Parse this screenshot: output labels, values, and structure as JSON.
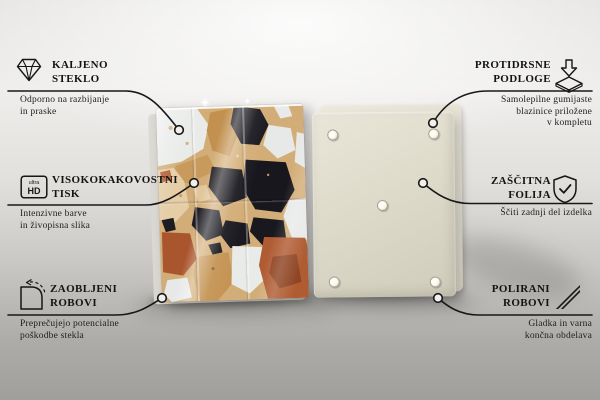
{
  "callouts": {
    "left": [
      {
        "id": "tempered-glass",
        "icon": "diamond-icon",
        "title_lines": [
          "KALJENO",
          "STEKLO"
        ],
        "subtitle_lines": [
          "Odporno na razbijanje",
          "in praske"
        ]
      },
      {
        "id": "high-quality-print",
        "icon": "ultra-hd-icon",
        "icon_text_top": "ultra",
        "icon_text_bottom": "HD",
        "title_lines": [
          "VISOKOKAKOVOSTNI",
          "TISK"
        ],
        "subtitle_lines": [
          "Intenzivne barve",
          "in živopisna slika"
        ]
      },
      {
        "id": "rounded-edges",
        "icon": "rounded-corner-icon",
        "title_lines": [
          "ZAOBLJENI",
          "ROBOVI"
        ],
        "subtitle_lines": [
          "Preprečujejo potencialne",
          "poškodbe stekla"
        ]
      }
    ],
    "right": [
      {
        "id": "anti-slip-pads",
        "icon": "anti-slip-pad-icon",
        "title_lines": [
          "PROTIDRSNE",
          "PODLOGE"
        ],
        "subtitle_lines": [
          "Samolepilne gumijaste",
          "blazinice priložene",
          "v kompletu"
        ]
      },
      {
        "id": "protective-film",
        "icon": "shield-check-icon",
        "title_lines": [
          "ZAŠČITNA",
          "FOLIJA"
        ],
        "subtitle_lines": [
          "Ščiti zadnji del izdelka"
        ]
      },
      {
        "id": "polished-edges",
        "icon": "polished-edges-icon",
        "title_lines": [
          "POLIRANI",
          "ROBOVI"
        ],
        "subtitle_lines": [
          "Gladka in varna",
          "končna obdelava"
        ]
      }
    ]
  },
  "product": {
    "front_panel": "terrazzo-print-glass-board",
    "back_panel": "cream-back-panel-with-pads",
    "back_pad_count": 5
  },
  "colors": {
    "text": "#141414",
    "connector_line": "#181818",
    "background_top": "#f0efed",
    "background_bottom": "#a19f9b",
    "back_panel": "#dedbcb",
    "terrazzo_tan": "#d3ad77",
    "terrazzo_black": "#1a1a20",
    "terrazzo_white": "#e9ebe9",
    "terrazzo_rust": "#a9552d",
    "terrazzo_beige": "#e5cda6",
    "terrazzo_caramel": "#c2914f"
  }
}
